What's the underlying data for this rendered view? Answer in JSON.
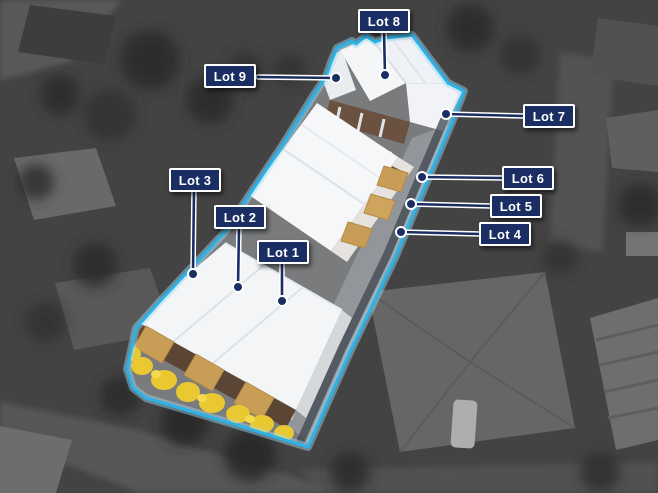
{
  "labels": [
    {
      "id": "lot-1",
      "text": "Lot 1"
    },
    {
      "id": "lot-2",
      "text": "Lot 2"
    },
    {
      "id": "lot-3",
      "text": "Lot 3"
    },
    {
      "id": "lot-4",
      "text": "Lot 4"
    },
    {
      "id": "lot-5",
      "text": "Lot 5"
    },
    {
      "id": "lot-6",
      "text": "Lot 6"
    },
    {
      "id": "lot-7",
      "text": "Lot 7"
    },
    {
      "id": "lot-8",
      "text": "Lot 8"
    },
    {
      "id": "lot-9",
      "text": "Lot 9"
    }
  ],
  "colors": {
    "label_bg": "#1b2e63",
    "label_border": "#ffffff",
    "label_text": "#ffffff",
    "boundary": "#2bb3e8",
    "leader_line": "#1b2e63"
  }
}
